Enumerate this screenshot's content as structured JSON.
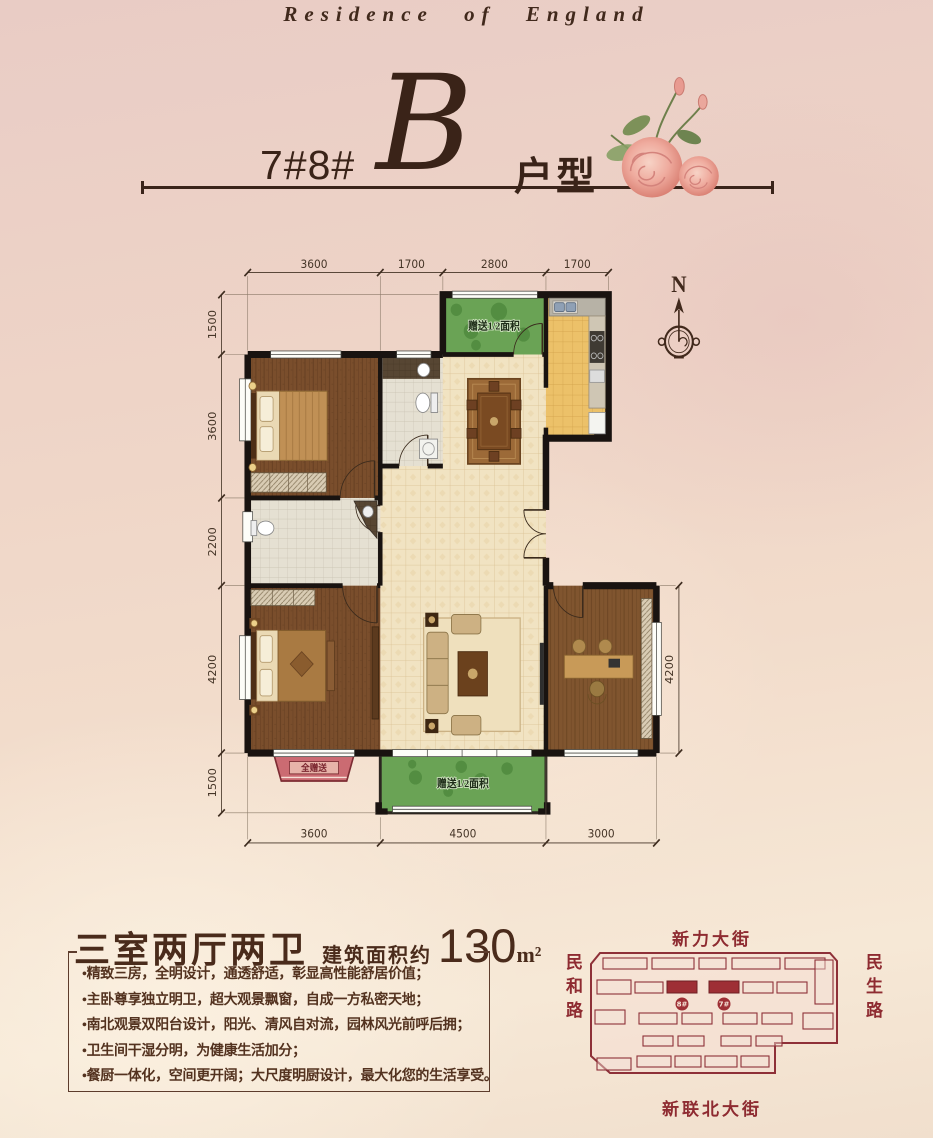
{
  "header": {
    "tagline": "Residence of England",
    "block_numbers": "7#8#",
    "unit_letter": "B",
    "unit_type_label": "户型"
  },
  "floor_plan": {
    "compass_north": "N",
    "dims_top": [
      "3600",
      "1700",
      "2800",
      "1700"
    ],
    "dims_left": [
      "1500",
      "3600",
      "2200",
      "4200",
      "1500"
    ],
    "dim_right": "4200",
    "dims_bottom": [
      "3600",
      "4500",
      "3000"
    ],
    "labels": {
      "north_balcony": "赠送1/2面积",
      "south_balcony": "赠送1/2面积",
      "bay_window": "全赠送"
    }
  },
  "summary": {
    "layout_title": "三室两厅两卫",
    "area_prefix": "建筑面积约",
    "area_value": "130",
    "area_unit": "m²",
    "features": [
      "•精致三房，全明设计，通透舒适，彰显高性能舒居价值；",
      "•主卧尊享独立明卫，超大观景飘窗，自成一方私密天地；",
      "•南北观景双阳台设计，阳光、清风自对流，园林风光前呼后拥；",
      "•卫生间干湿分明，为健康生活加分；",
      "•餐厨一体化，空间更开阔；大尺度明厨设计，最大化您的生活享受。"
    ]
  },
  "site_map": {
    "street_top": "新力大街",
    "street_left": "民和路",
    "street_right": "民生路",
    "street_bottom": "新联北大街",
    "building_8": "8#",
    "building_7": "7#"
  },
  "colors": {
    "accent_brown": "#3a2318",
    "street_maroon": "#8e2b31",
    "balcony_green": "#6aa355",
    "gift_bay_red": "#cb6b72"
  }
}
